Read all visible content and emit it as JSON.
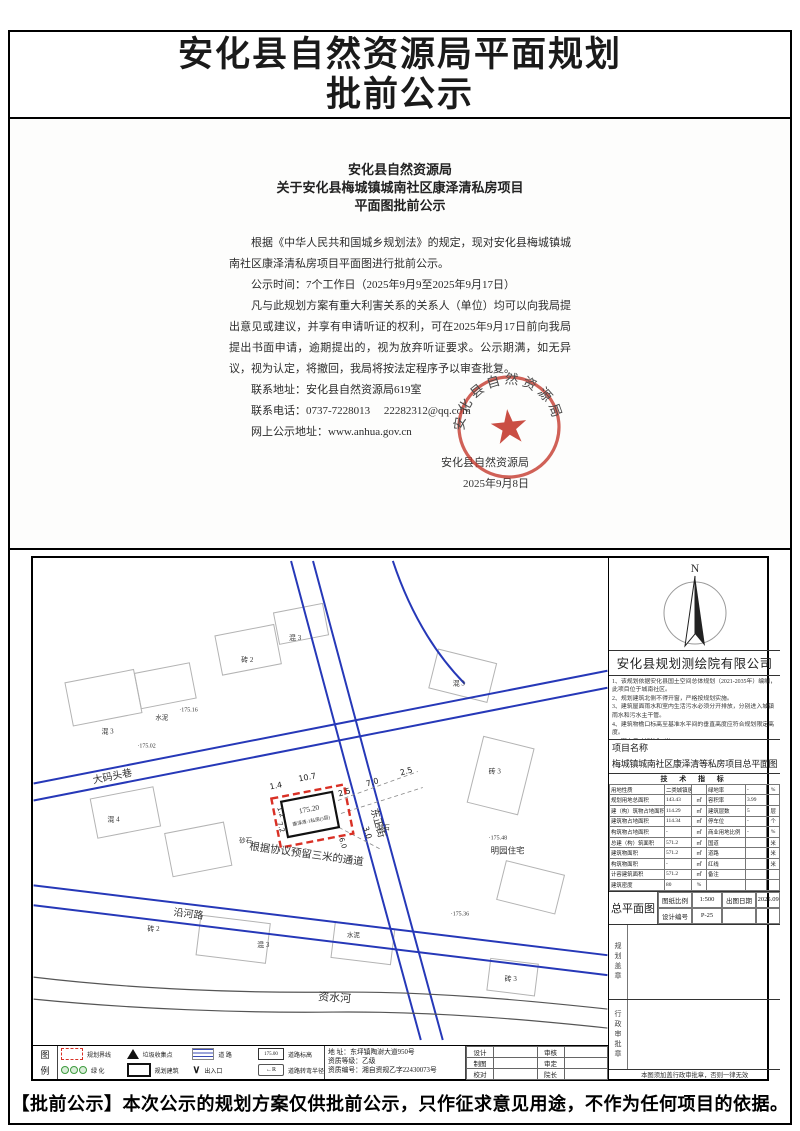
{
  "page": {
    "title_line1": "安化县自然资源局平面规划",
    "title_line2": "批前公示",
    "footer": "【批前公示】本次公示的规划方案仅供批前公示，只作征求意见用途，不作为任何项目的依据。"
  },
  "letter": {
    "heading1": "安化县自然资源局",
    "heading2": "关于安化县梅城镇城南社区康泽清私房项目",
    "heading3": "平面图批前公示",
    "para1": "根据《中华人民共和国城乡规划法》的规定，现对安化县梅城镇城南社区康泽清私房项目平面图进行批前公示。",
    "para2": "公示时间：7个工作日（2025年9月9至2025年9月17日）",
    "para3": "凡与此规划方案有重大利害关系的关系人（单位）均可以向我局提出意见或建议，并享有申请听证的权利，可在2025年9月17日前向我局提出书面申请，逾期提出的，视为放弃听证要求。公示期满，如无异议，视为认定，将撤回，我局将按法定程序予以审查批复。",
    "contact_address": "联系地址：安化县自然资源局619室",
    "contact_phone": "联系电话：0737-7228013",
    "contact_email": "22282312@qq.com",
    "contact_web": "网上公示地址：www.anhua.gov.cn",
    "signature": "安化县自然资源局",
    "date": "2025年9月8日",
    "seal_text": "安化县自然资源局"
  },
  "plan": {
    "north_label": "N",
    "company": "安化县规划测绘院有限公司",
    "notes": [
      "1、该规划依据安化县国土空间总体规划（2021-2035年）编制，此项目位于城南社区。",
      "2、规划建筑北侧不得开窗，严格按规划实施。",
      "3、建筑屋面雨水和室内生活污水必须分开排放，分别进入城镇雨水和污水主干管。",
      "4、建筑物檐口标高至基准水平间的垂直高度应符合规划限定高度。",
      "5、图中尺寸标注为“米”。",
      "6、规划期限为2年。"
    ],
    "project_label": "项目名称",
    "project_name": "梅城镇城南社区康泽清等私房项目总平面图",
    "tech_table": {
      "title": "技 术 指 标",
      "rows": [
        [
          "用地性质",
          "二类城镇居住用地",
          "",
          "绿地率",
          "-",
          "%"
        ],
        [
          "规划用地总面积",
          "143.43",
          "㎡",
          "容积率",
          "3.99",
          ""
        ],
        [
          "建（构）筑物占地面积",
          "114.29",
          "㎡",
          "建筑层数",
          "5",
          "层"
        ],
        [
          "建筑物占地面积",
          "114.34",
          "㎡",
          "停车位",
          "-",
          "个"
        ],
        [
          "构筑物占地面积",
          "-",
          "㎡",
          "商业用地比例",
          "-",
          "%"
        ],
        [
          "总建（构）筑面积",
          "571.2",
          "㎡",
          "国道",
          "",
          "米"
        ],
        [
          "建筑物面积",
          "571.2",
          "㎡",
          "道路",
          "",
          "米"
        ],
        [
          "构筑物面积",
          "-",
          "㎡",
          "红线",
          "",
          "米"
        ],
        [
          "计容建筑面积",
          "571.2",
          "㎡",
          "备注",
          "",
          ""
        ],
        [
          "建筑密度",
          "80",
          "%",
          "",
          "",
          ""
        ]
      ]
    },
    "titleblock": {
      "drawing_name": "总平面图",
      "scale_label": "图纸比例",
      "scale": "1:500",
      "date_label": "出图日期",
      "date": "2025.09",
      "design_no_label": "设计编号",
      "design_no": "P-25"
    },
    "stamps": {
      "plan_seal": "规划盖章",
      "admin_seal": "行政审批章",
      "note": "本图须加盖行政审批章，否则一律无效"
    },
    "legend": {
      "col_title_top": "图",
      "col_title_bottom": "例",
      "items": [
        {
          "icon": "red-dashed-rect",
          "label": "规划界线"
        },
        {
          "icon": "triangle",
          "label": "垃圾收集点"
        },
        {
          "icon": "road-stripes",
          "label": "道  路"
        },
        {
          "icon": "elevation-box",
          "label": "道路标高",
          "glyph": "175.00"
        },
        {
          "icon": "green-circles",
          "label": "绿  化"
        },
        {
          "icon": "building-rect",
          "label": "规划建筑"
        },
        {
          "icon": "v-arrow",
          "label": "出入口",
          "glyph": "∨"
        },
        {
          "icon": "turn-radius",
          "label": "道路转弯半径",
          "glyph": "←R"
        }
      ]
    },
    "credentials": {
      "address": "地    址：东坪镇陶澍大道950号",
      "grade": "资质等级：乙级",
      "cert_no": "资质编号：湘自资规乙字22430073号"
    },
    "signoff": {
      "rows": [
        [
          "设计",
          "",
          "审核",
          ""
        ],
        [
          "制图",
          "",
          "审定",
          ""
        ],
        [
          "校对",
          "",
          "院长",
          ""
        ]
      ]
    },
    "map": {
      "building_elevation": "175.20",
      "building_name": "康泽清-1私房(5层)",
      "annotation": "根据协议预留三米的通道",
      "labels": [
        "大码头巷",
        "东正街",
        "沿河路",
        "资水河",
        "明园住宅",
        "混 3",
        "水泥",
        "·175.02",
        "·175.16",
        "砖 2",
        "混 3",
        "混 3",
        "砖 3",
        "·175.48",
        "混 4",
        "砂石",
        "砂石",
        "砖 2",
        "混 3",
        "水泥",
        "·175.36",
        "砖 3"
      ],
      "dims": [
        "1.4",
        "10.7",
        "2.5",
        "7.0",
        "2.5",
        "3.0",
        "1.2",
        "7.2",
        "6.0"
      ]
    }
  }
}
